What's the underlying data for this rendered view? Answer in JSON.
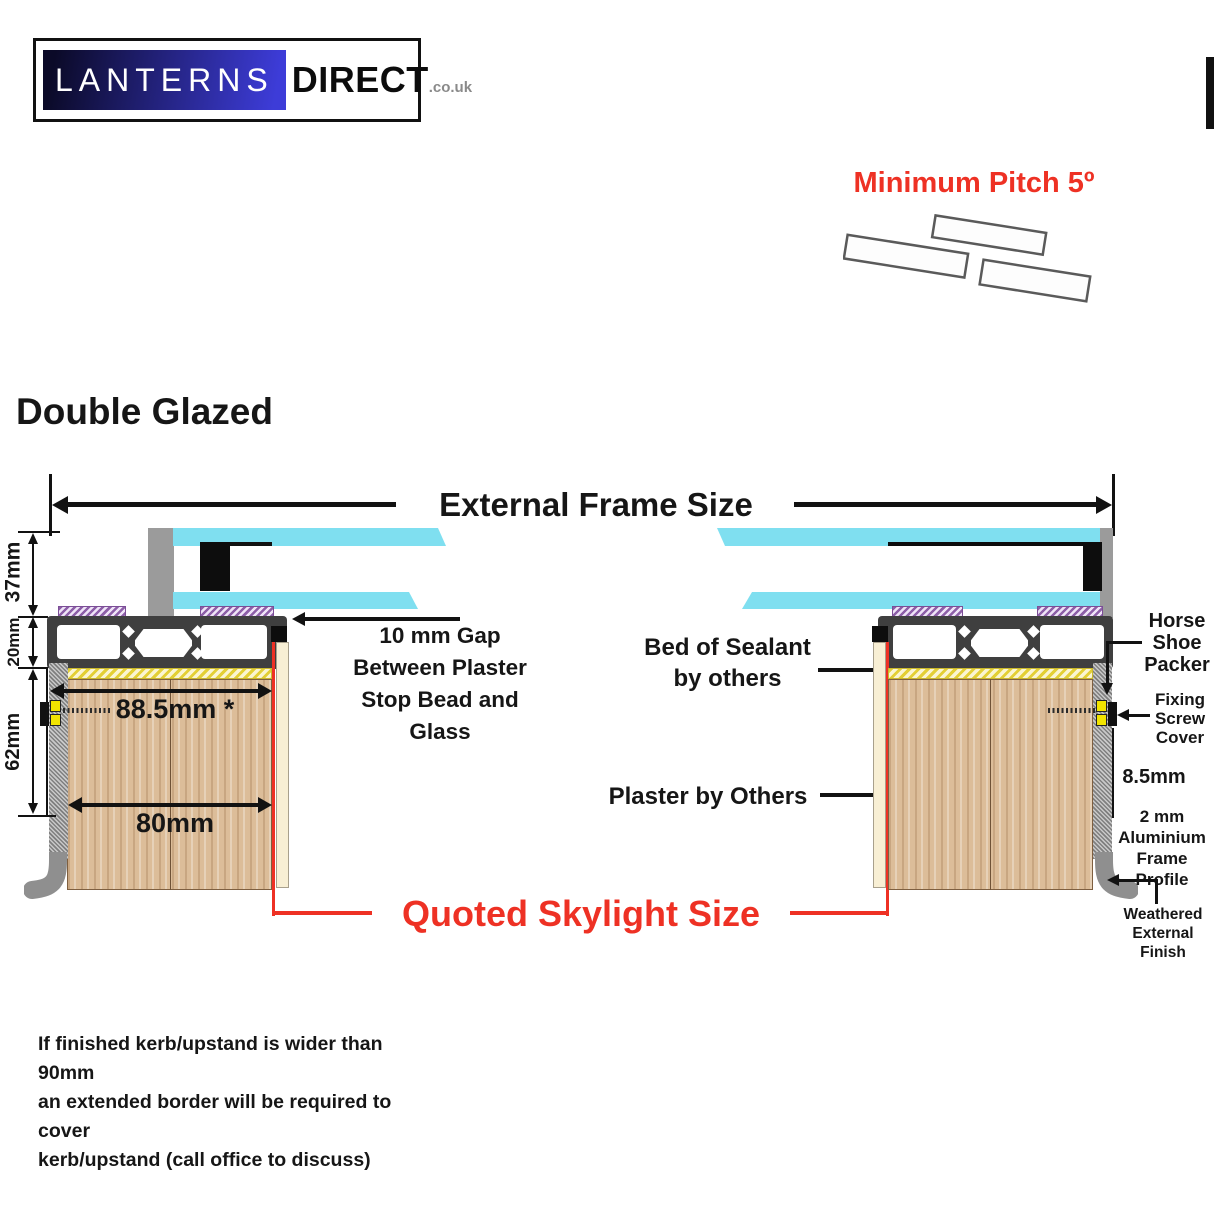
{
  "logo": {
    "word1": "LANTERNS",
    "word2": "DIRECT",
    "suffix": ".co.uk"
  },
  "pitch": {
    "label": "Minimum Pitch 5º"
  },
  "title": "Double Glazed",
  "frame_dim_label": "External Frame Size",
  "dimensions": {
    "glass_unit_height": "37mm",
    "frame_height": "20mm",
    "kerb_height": "62mm",
    "overall_width": "88.5mm *",
    "kerb_width": "80mm",
    "edge_gap": "8.5mm"
  },
  "annotations": {
    "gap": [
      "10 mm Gap",
      "Between Plaster",
      "Stop Bead and",
      "Glass"
    ],
    "sealant": [
      "Bed of Sealant",
      "by others"
    ],
    "plaster": "Plaster by Others",
    "horseshoe": [
      "Horse",
      "Shoe",
      "Packer"
    ],
    "fixing_screw": [
      "Fixing",
      "Screw",
      "Cover"
    ],
    "alu_profile": [
      "2 mm",
      "Aluminium",
      "Frame Profile"
    ],
    "weathered": [
      "Weathered",
      "External",
      "Finish"
    ],
    "quoted": "Quoted Skylight Size"
  },
  "footer": [
    "If finished kerb/upstand is wider than 90mm",
    "an extended border will be required to cover",
    "kerb/upstand (call office to discuss)"
  ],
  "colors": {
    "red": "#ee3124",
    "cyan": "#7fdff0",
    "purple": "#8d5fa8",
    "frame_dark": "#3f3f3f",
    "wood": "#dcbd99",
    "sealant_yellow": "#e8d73c",
    "cream": "#f8efd4",
    "gray": "#9b9b9b",
    "screw_yellow": "#f2e400"
  }
}
